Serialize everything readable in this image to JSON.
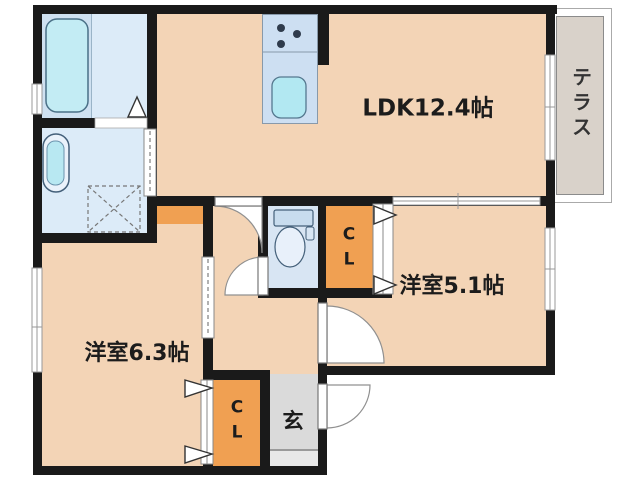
{
  "rooms": {
    "ldk": {
      "label": "LDK12.4帖"
    },
    "bedroom_right": {
      "label": "洋室5.1帖"
    },
    "bedroom_left": {
      "label": "洋室6.3帖"
    },
    "terrace": {
      "label": "テラス"
    },
    "entrance": {
      "label": "玄"
    },
    "closet_right": {
      "label": "C\nL"
    },
    "closet_bottom": {
      "label": "C\nL"
    }
  },
  "colors": {
    "room_fill": "#f3d4b6",
    "closet_fill": "#f0a052",
    "wet_area_fill": "#dcebf8",
    "bath_fill": "#cfe1f1",
    "toilet_room_fill": "#d8e5f3",
    "kitchen_counter_fill": "#cddff2",
    "tub_fill": "#c3ecf4",
    "sink_fill": "#b2e8f2",
    "terrace_fill": "#d9d2ca",
    "entrance_fill": "#dadada",
    "wall": "#1a1a1a"
  }
}
